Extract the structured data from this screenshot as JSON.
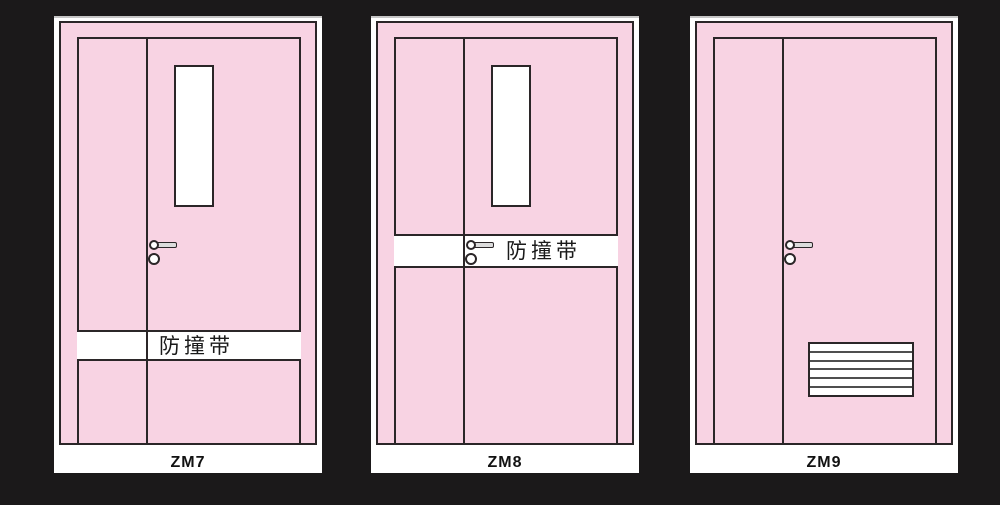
{
  "background_color": "#1b191a",
  "colors": {
    "door_fill": "#f8d3e3",
    "outline": "#2b2628",
    "mat": "#ffffff",
    "louver_line": "#4f4f4f"
  },
  "doors": [
    {
      "label": "ZM7",
      "band_text": "防撞带",
      "band_position": "lower",
      "features": [
        "vision-panel",
        "lever-handle",
        "anti-collision-band"
      ]
    },
    {
      "label": "ZM8",
      "band_text": "防撞带",
      "band_position": "handle-height",
      "features": [
        "vision-panel",
        "lever-handle",
        "anti-collision-band"
      ]
    },
    {
      "label": "ZM9",
      "band_text": "",
      "band_position": "none",
      "features": [
        "lever-handle",
        "vent-louver"
      ]
    }
  ]
}
